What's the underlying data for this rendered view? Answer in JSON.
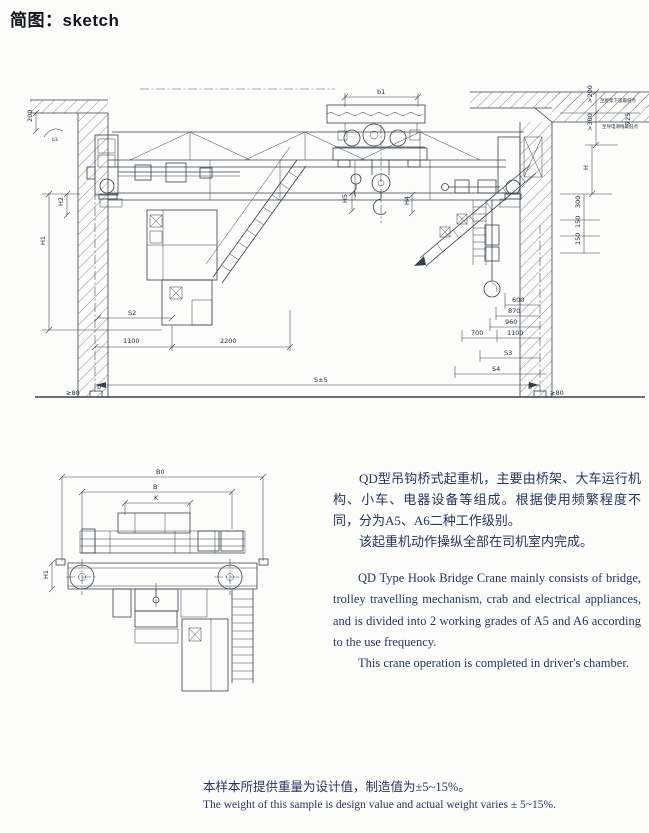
{
  "page": {
    "title": "简图：sketch"
  },
  "description": {
    "zh1": "QD型吊钩桥式起重机，主要由桥架、大车运行机构、小车、电器设备等组成。根据使用频繁程度不同，分为A5、A6二种工作级别。",
    "zh2": "该起重机动作操纵全部在司机室内完成。",
    "en1": "QD Type Hook Bridge Crane mainly consists of bridge, trolley travelling mechanism, crab and electrical appliances, and is divided into 2 working grades of A5 and A6 according to the use frequency.",
    "en2": "This crane operation is completed in driver's chamber."
  },
  "footer": {
    "zh": "本样本所提供重量为设计值，制造值为±5~15%。",
    "en": "The weight of this sample is design value and actual weight varies ± 5~15%."
  },
  "front_view": {
    "dims": {
      "d200": "200",
      "b3": "b3",
      "h2": "H2",
      "h1": "H1",
      "s2": "S2",
      "d1100": "1100",
      "d2200": "2200",
      "span": "S±5",
      "ge80_left": "≥80",
      "b_left": "b",
      "b1": "b1",
      "h5": "H5",
      "h4": "H4",
      "d600": "600",
      "d870": "870",
      "d960": "960",
      "d700": "700",
      "d1100r": "1100",
      "s3": "S3",
      "s4": "S4",
      "b_right": "b",
      "ge80_right": "≥80",
      "gt200": ">200",
      "gt300": ">300",
      "d725": "725",
      "H": "H",
      "d300": "300",
      "d150a": "150",
      "d150b": "150",
      "note_roof": "至屋架下弦最低点",
      "note_wire": "至导电滑线最低点"
    }
  },
  "side_view": {
    "dims": {
      "b0": "B0",
      "b": "B",
      "k": "K",
      "h1": "H1"
    }
  }
}
